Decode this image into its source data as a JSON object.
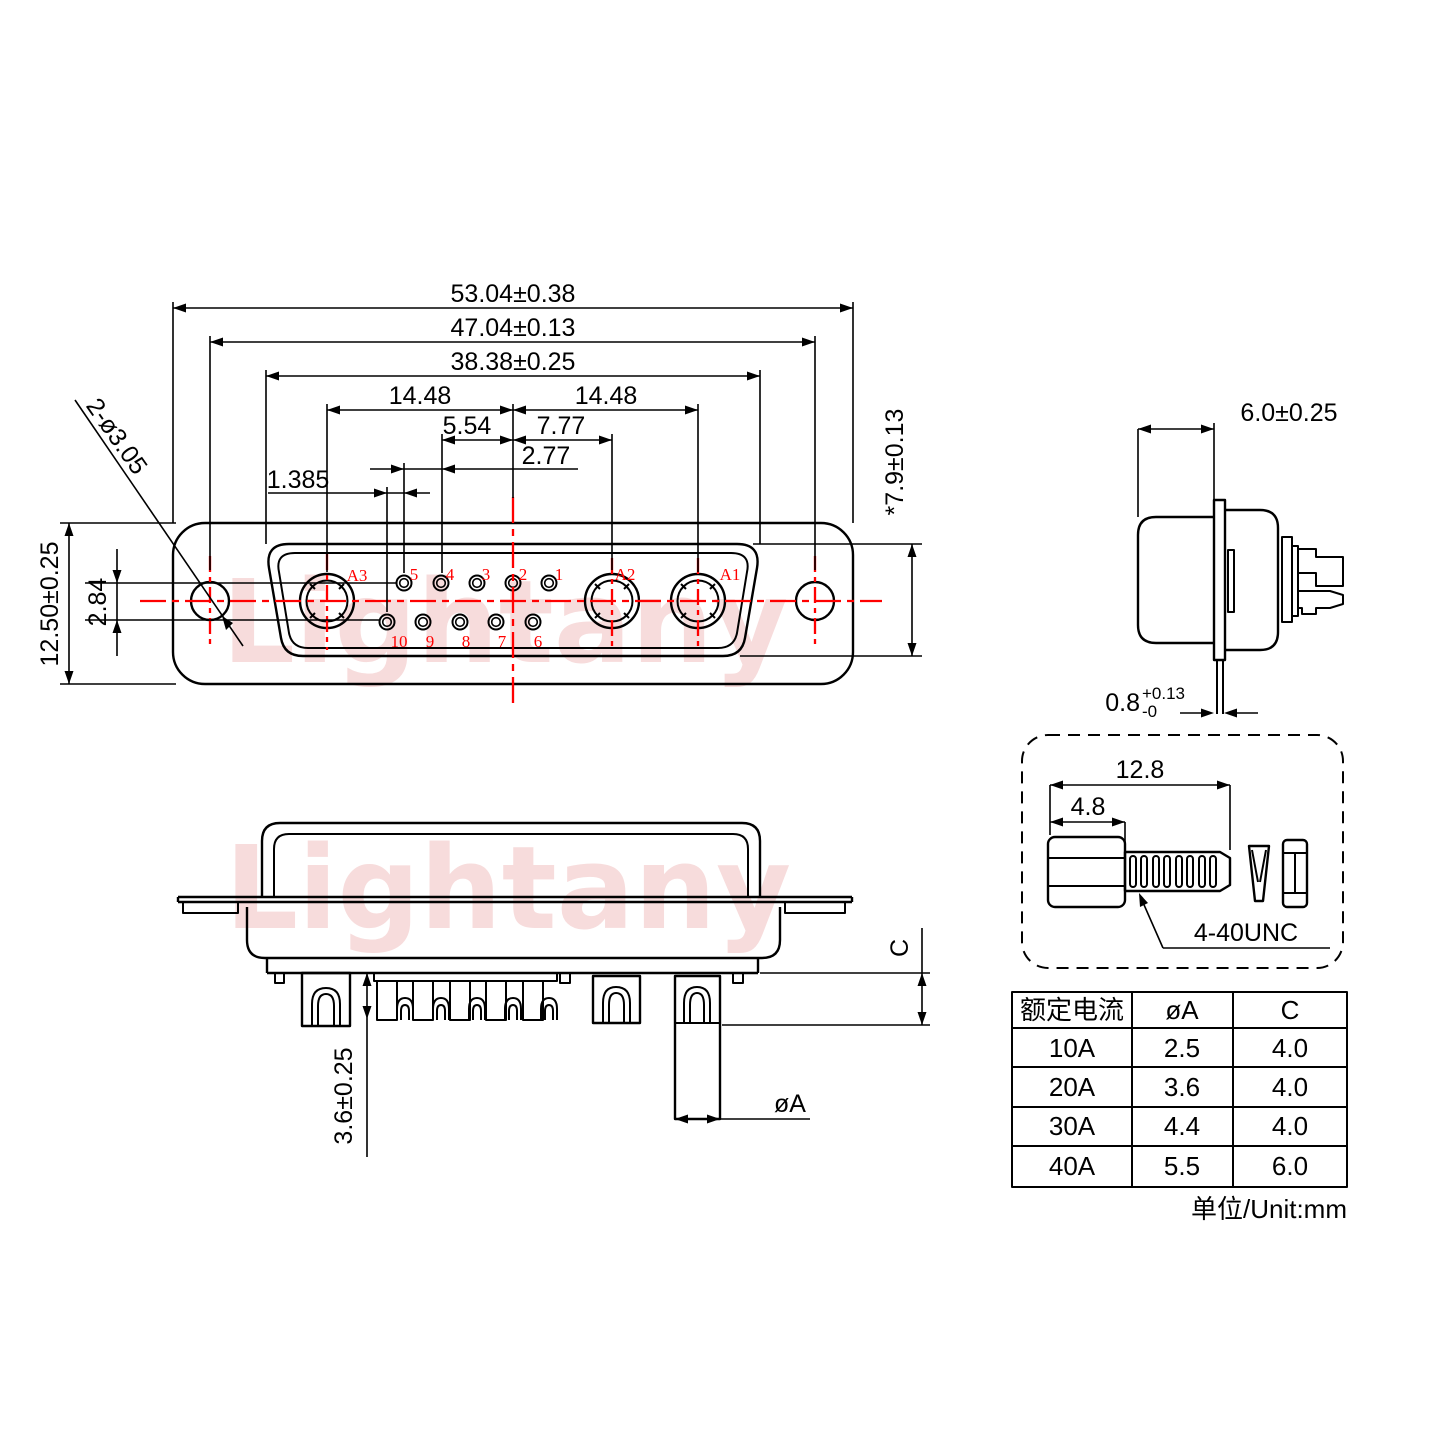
{
  "watermark": {
    "text": "Lightany",
    "color": "#f7dcdc"
  },
  "colors": {
    "line": "#000000",
    "accent_red": "#ff0000"
  },
  "front_view": {
    "dims": {
      "width_outer": "53.04±0.38",
      "width_holes": "47.04±0.13",
      "width_cavity": "38.38±0.25",
      "pitch_left": "14.48",
      "pitch_right": "14.48",
      "pitch_554": "5.54",
      "pitch_777": "7.77",
      "pitch_277": "2.77",
      "pitch_1385": "1.385",
      "height_outer": "12.50±0.25",
      "row_spacing": "2.84",
      "mount_holes": "2-ø3.05",
      "cavity_height": "*7.9±0.13"
    },
    "contacts": [
      "A3",
      "A2",
      "A1"
    ],
    "pins_top": [
      "5",
      "4",
      "3",
      "2",
      "1"
    ],
    "pins_bottom": [
      "10",
      "9",
      "8",
      "7",
      "6"
    ]
  },
  "side_view": {
    "dims": {
      "depth": "6.0±0.25",
      "plate_thickness": "0.8",
      "plate_tol_sup": "+0.13",
      "plate_tol_sub": "-0"
    }
  },
  "screw_detail": {
    "dims": {
      "length": "12.8",
      "head": "4.8"
    },
    "thread_label": "4-40UNC"
  },
  "bottom_view": {
    "dims": {
      "pin_length": "3.6±0.25",
      "pin_diameter": "øA",
      "c_ref": "C"
    }
  },
  "spec_table": {
    "headers": [
      "额定电流",
      "øA",
      "C"
    ],
    "rows": [
      [
        "10A",
        "2.5",
        "4.0"
      ],
      [
        "20A",
        "3.6",
        "4.0"
      ],
      [
        "30A",
        "4.4",
        "4.0"
      ],
      [
        "40A",
        "5.5",
        "6.0"
      ]
    ],
    "unit_note": "单位/Unit:mm"
  }
}
